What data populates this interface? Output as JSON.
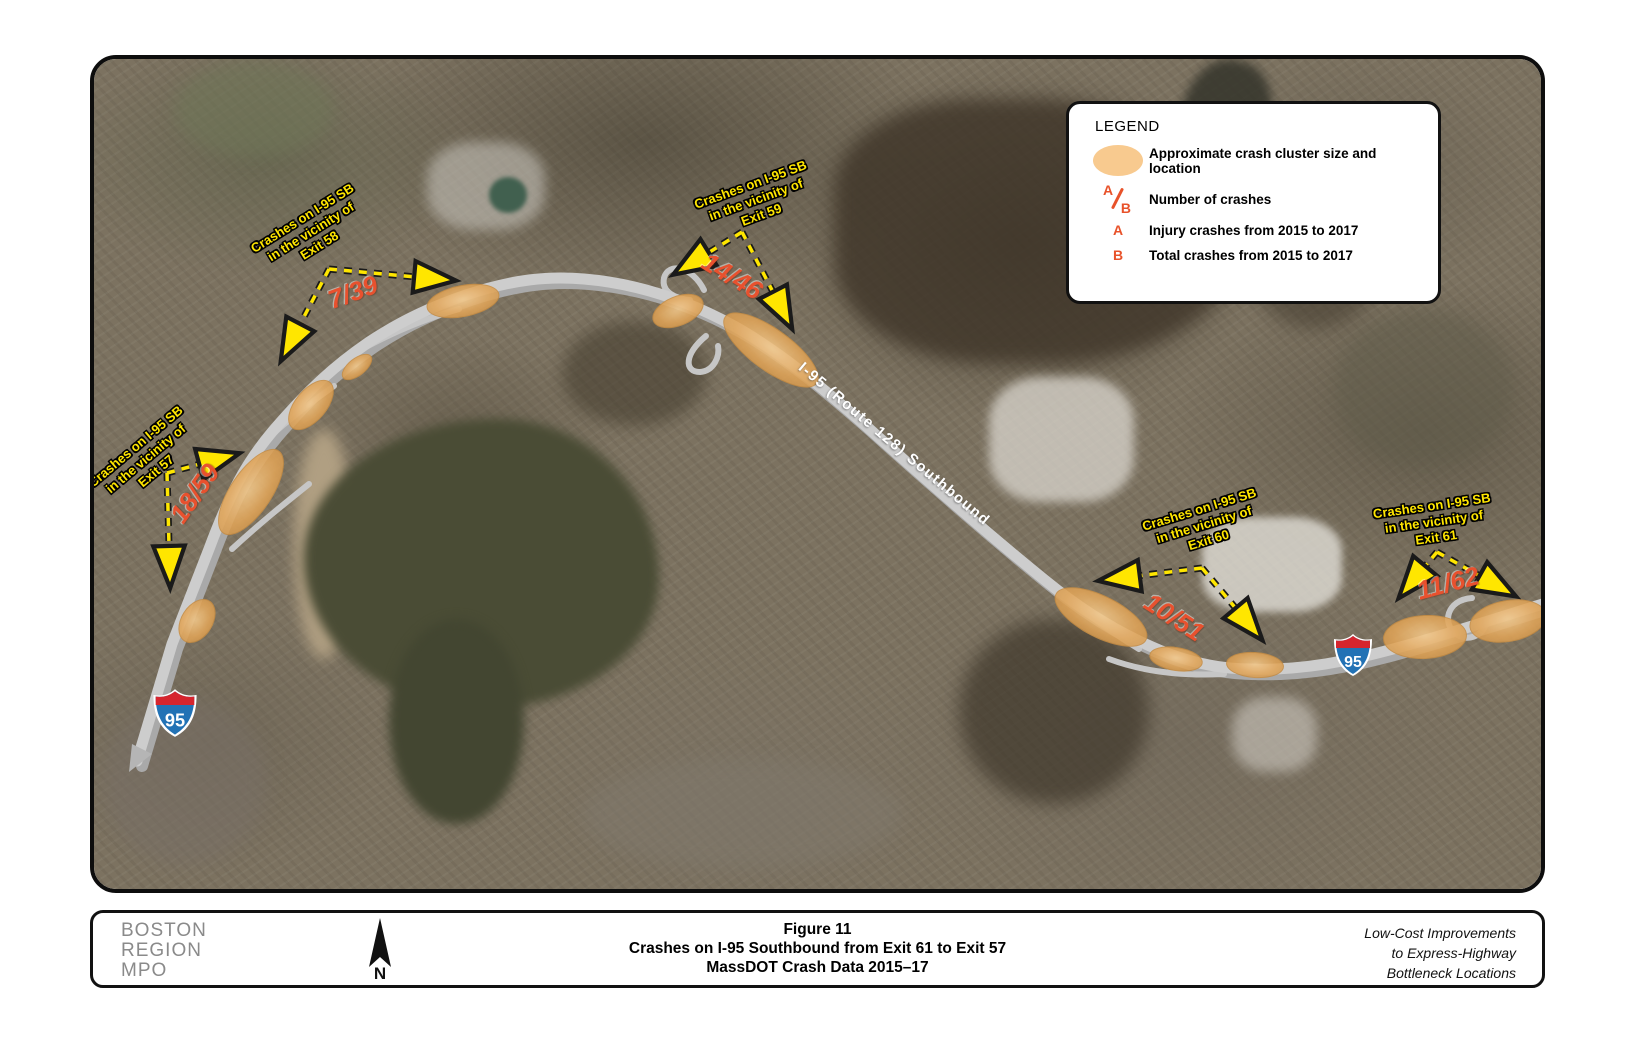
{
  "legend": {
    "title": "LEGEND",
    "cluster_label": "Approximate crash cluster size and location",
    "ab_label": "Number of crashes",
    "a_symbol": "A",
    "b_symbol": "B",
    "a_label": "Injury crashes from 2015 to 2017",
    "b_label": "Total crashes from 2015 to 2017"
  },
  "map": {
    "road_label": "I-95 (Route 128) Southbound",
    "shield_number": "95",
    "annotations": [
      {
        "line1": "Crashes on I-95 SB",
        "line2": "in the vicinity of",
        "line3": "Exit 58",
        "crashes": "7/39"
      },
      {
        "line1": "Crashes on I-95 SB",
        "line2": "in the vicinity of",
        "line3": "Exit 59",
        "crashes": "14/46"
      },
      {
        "line1": "Crashes on I-95 SB",
        "line2": "in the vicinity of",
        "line3": "Exit 57",
        "crashes": "18/59"
      },
      {
        "line1": "Crashes on I-95 SB",
        "line2": "in the vicinity of",
        "line3": "Exit 60",
        "crashes": "10/51"
      },
      {
        "line1": "Crashes on I-95 SB",
        "line2": "in the vicinity of",
        "line3": "Exit 61",
        "crashes": "11/62"
      }
    ],
    "clusters": [
      {
        "x": 368,
        "y": 241,
        "w": 72,
        "h": 30,
        "rot": -11
      },
      {
        "x": 262,
        "y": 307,
        "w": 34,
        "h": 16,
        "rot": -38
      },
      {
        "x": 216,
        "y": 345,
        "w": 58,
        "h": 30,
        "rot": -50
      },
      {
        "x": 156,
        "y": 432,
        "w": 98,
        "h": 40,
        "rot": -56
      },
      {
        "x": 102,
        "y": 561,
        "w": 46,
        "h": 30,
        "rot": -58
      },
      {
        "x": 583,
        "y": 251,
        "w": 52,
        "h": 28,
        "rot": -22
      },
      {
        "x": 676,
        "y": 290,
        "w": 112,
        "h": 40,
        "rot": 36
      },
      {
        "x": 1006,
        "y": 557,
        "w": 100,
        "h": 40,
        "rot": 27
      },
      {
        "x": 1081,
        "y": 599,
        "w": 52,
        "h": 22,
        "rot": 9
      },
      {
        "x": 1160,
        "y": 605,
        "w": 56,
        "h": 24,
        "rot": 4
      },
      {
        "x": 1330,
        "y": 577,
        "w": 82,
        "h": 42,
        "rot": -3
      },
      {
        "x": 1413,
        "y": 561,
        "w": 76,
        "h": 40,
        "rot": -10
      }
    ],
    "colors": {
      "cluster": "#E3A65C",
      "number": "#E8512E",
      "label_yellow": "#FFE600",
      "road_light": "#CDCDCD",
      "road_dark": "#A9A9A9",
      "shield_blue": "#2272B5",
      "shield_red": "#D6252E"
    }
  },
  "footer": {
    "org_line1": "BOSTON",
    "org_line2": "REGION",
    "org_line3": "MPO",
    "north_label": "N",
    "title_line1": "Figure 11",
    "title_line2": "Crashes on I-95 Southbound from Exit 61 to Exit 57",
    "title_line3": "MassDOT Crash Data 2015–17",
    "project_line1": "Low-Cost Improvements",
    "project_line2": "to Express-Highway",
    "project_line3": "Bottleneck Locations"
  }
}
